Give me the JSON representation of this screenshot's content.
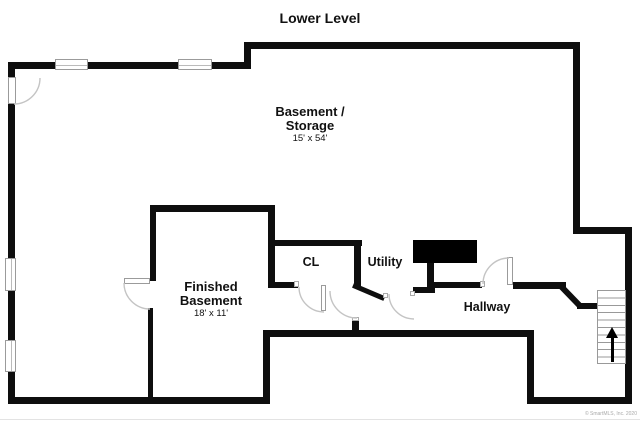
{
  "title": "Lower Level",
  "rooms": {
    "basement_storage": {
      "line1": "Basement /",
      "line2": "Storage",
      "dims": "15' x 54'"
    },
    "finished_basement": {
      "line1": "Finished",
      "line2": "Basement",
      "dims": "18' x 11'"
    },
    "closet": {
      "label": "CL"
    },
    "utility": {
      "label": "Utility"
    },
    "hallway": {
      "label": "Hallway"
    }
  },
  "icons": {
    "stairs_arrow": "up-arrow"
  },
  "watermark": "© SmartMLS, Inc. 2020",
  "colors": {
    "wall": "#0e0e0e",
    "door_arc": "#c4c4c4",
    "window_border": "#9b9b9b",
    "appliance": "#000000"
  }
}
